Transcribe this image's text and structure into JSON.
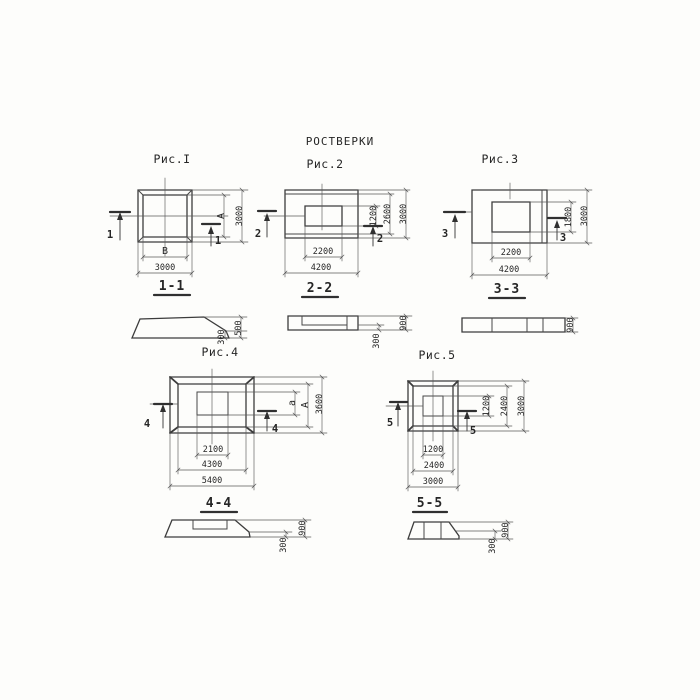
{
  "title": "РОСТВЕРКИ",
  "colors": {
    "line": "#3c3c3c",
    "text": "#262626",
    "paper": "#fdfdfb"
  },
  "figures": [
    {
      "label": "Рис.I",
      "section_label": "1-1",
      "plan": {
        "section_mark": "1",
        "width_dims": [
          "В",
          "3000"
        ],
        "height_dims": [
          "А",
          "3000"
        ]
      },
      "section": {
        "height_dims": [
          "500",
          "300"
        ]
      }
    },
    {
      "label": "Рис.2",
      "section_label": "2-2",
      "plan": {
        "section_mark": "2",
        "width_dims": [
          "2200",
          "4200"
        ],
        "height_dims": [
          "1200",
          "2600",
          "3000"
        ]
      },
      "section": {
        "height_dims": [
          "900",
          "300"
        ]
      }
    },
    {
      "label": "Рис.3",
      "section_label": "3-3",
      "plan": {
        "section_mark": "3",
        "width_dims": [
          "2200",
          "4200"
        ],
        "height_dims": [
          "1800",
          "3000"
        ]
      },
      "section": {
        "height_dims": [
          "900"
        ]
      }
    },
    {
      "label": "Рис.4",
      "section_label": "4-4",
      "plan": {
        "section_mark": "4",
        "width_dims": [
          "2100",
          "4300",
          "5400"
        ],
        "height_dims": [
          "а",
          "А",
          "3600"
        ]
      },
      "section": {
        "height_dims": [
          "900",
          "300"
        ]
      }
    },
    {
      "label": "Рис.5",
      "section_label": "5-5",
      "plan": {
        "section_mark": "5",
        "width_dims": [
          "1200",
          "2400",
          "3000"
        ],
        "height_dims": [
          "1200",
          "2400",
          "3000"
        ]
      },
      "section": {
        "height_dims": [
          "900",
          "300"
        ]
      }
    }
  ]
}
